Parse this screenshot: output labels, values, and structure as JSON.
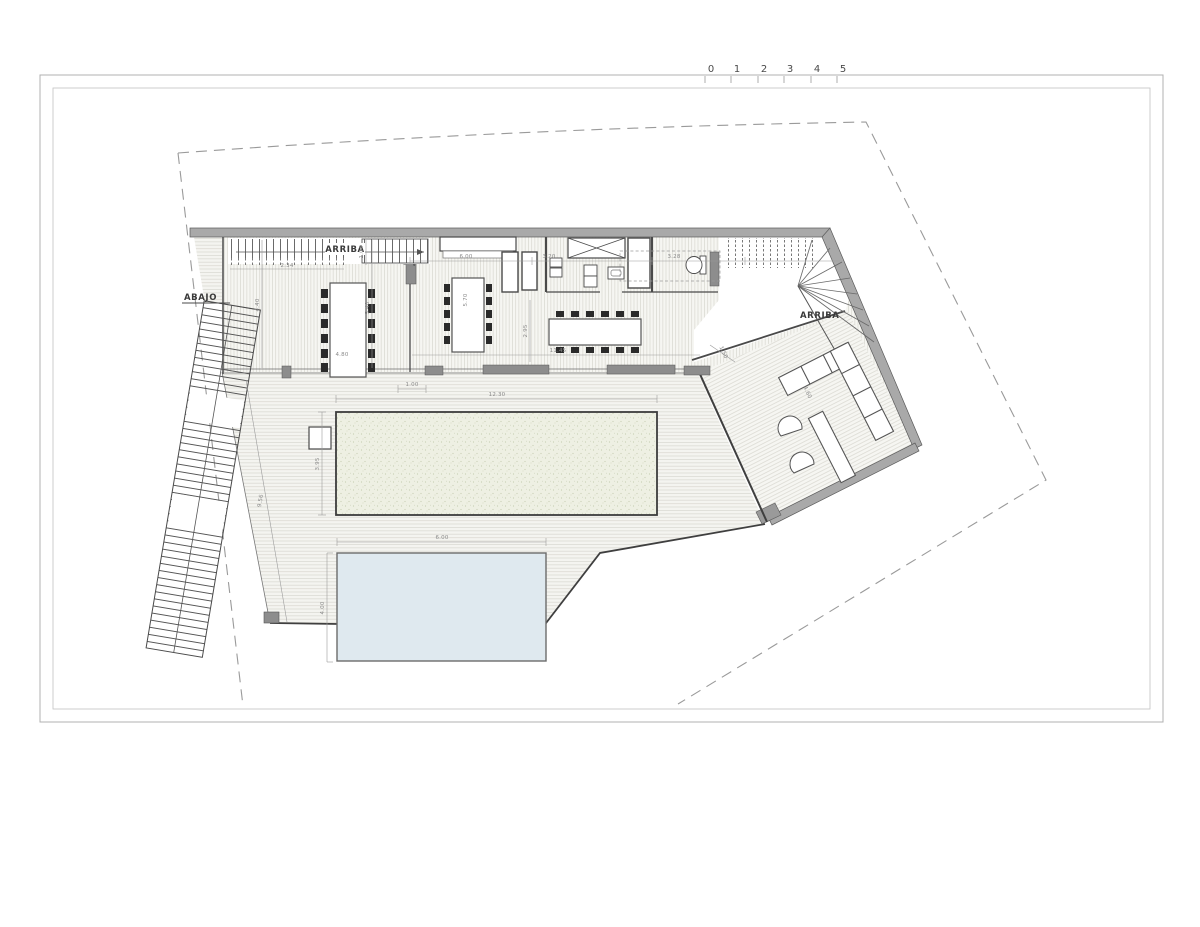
{
  "sheet": {
    "scale_bar": {
      "units": [
        "0",
        "1",
        "2",
        "3",
        "4",
        "5"
      ]
    }
  },
  "labels": {
    "stair_upper_left": "ARRIBA",
    "stair_upper_right": "ARRIBA",
    "stair_exterior": "ABAJO"
  },
  "dimensions": {
    "stair_run": "2.34",
    "stair_width": "1.04",
    "dining_depth_left": "4.40",
    "dining_depth_right": "5.40",
    "dining_table_length": "4.80",
    "kitchen_width": "6.00",
    "island_length": "5.70",
    "bath_width": "3.20",
    "bath2_width": "3.28",
    "kitchen_depth": "2.95",
    "south_front_width": "11.45",
    "terrace_step": "1.50",
    "living_width": "4.60",
    "pool_offset": "1.00",
    "pool_length": "12.30",
    "pool_width": "3.95",
    "deck_side": "9.56",
    "lower_pool_length": "6.00",
    "lower_pool_width": "4.00"
  },
  "colors": {
    "wall_gray": "#a9a9a9",
    "line_dark": "#3f3f3f",
    "hatch_line": "#dcdbd4",
    "floor_bg": "#f6f6f2",
    "pool_fill": "#eef0e3",
    "pool_dot": "#c7cdb2",
    "water_blue": "#dfe9ef",
    "boundary_dash": "#9a9a9a",
    "dim_gray": "#8a8a8a"
  }
}
